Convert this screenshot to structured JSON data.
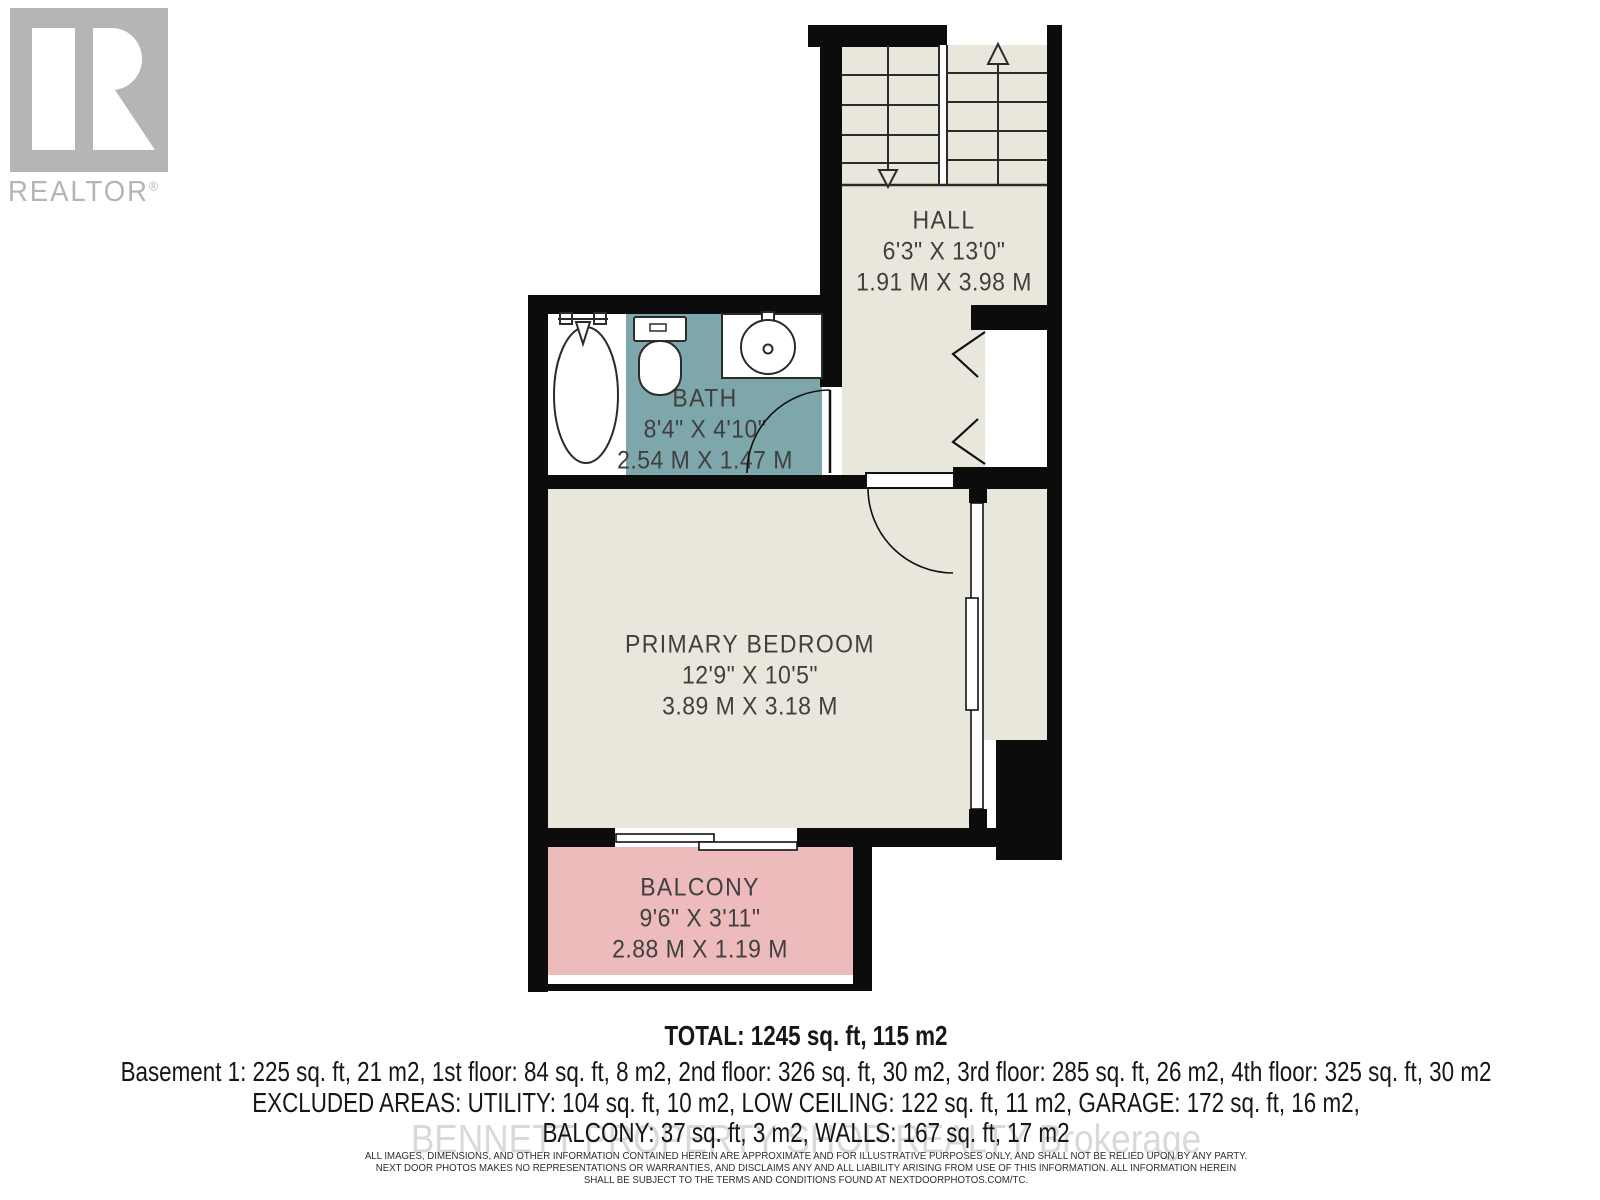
{
  "branding": {
    "logo_text": "REALTOR",
    "registered_mark": "®"
  },
  "floor_plan": {
    "rooms": [
      {
        "name": "HALL",
        "dimensions_imperial": "6'3\" X 13'0\"",
        "dimensions_metric": "1.91 M X 3.98 M"
      },
      {
        "name": "BATH",
        "dimensions_imperial": "8'4\" X 4'10\"",
        "dimensions_metric": "2.54 M X 1.47 M"
      },
      {
        "name": "PRIMARY BEDROOM",
        "dimensions_imperial": "12'9\" X 10'5\"",
        "dimensions_metric": "3.89 M X 3.18 M"
      },
      {
        "name": "BALCONY",
        "dimensions_imperial": "9'6\" X 3'11\"",
        "dimensions_metric": "2.88 M X 1.19 M"
      }
    ],
    "features": [
      "staircase-up",
      "staircase-down",
      "bathtub",
      "toilet",
      "sink",
      "swing-doors",
      "bifold-closet-door",
      "window",
      "sliding-patio-door"
    ]
  },
  "summary": {
    "total": "TOTAL: 1245 sq. ft, 115 m2",
    "floors": "Basement 1: 225 sq. ft, 21 m2, 1st floor: 84 sq. ft, 8 m2, 2nd floor: 326 sq. ft, 30 m2, 3rd floor: 285 sq. ft, 26 m2, 4th floor: 325 sq. ft, 30 m2",
    "excluded_line1": "EXCLUDED AREAS: UTILITY: 104 sq. ft, 10 m2, LOW CEILING: 122 sq. ft, 11 m2, GARAGE: 172 sq. ft, 16 m2,",
    "excluded_line2": "BALCONY: 37 sq. ft, 3 m2, WALLS: 167 sq. ft, 17 m2"
  },
  "watermark": "BENNETT PROPERTY SHOP REALTY Brokerage",
  "disclaimer": {
    "line1": "ALL IMAGES, DIMENSIONS, AND OTHER INFORMATION CONTAINED HEREIN ARE APPROXIMATE AND FOR ILLUSTRATIVE PURPOSES ONLY, AND SHALL NOT BE RELIED UPON BY ANY PARTY.",
    "line2": "NEXT DOOR PHOTOS MAKES NO REPRESENTATIONS OR WARRANTIES, AND DISCLAIMS ANY AND ALL LIABILITY ARISING FROM USE OF THIS INFORMATION. ALL INFORMATION HEREIN",
    "line3": "SHALL BE SUBJECT TO THE TERMS AND CONDITIONS FOUND AT NEXTDOORPHOTOS.COM/TC."
  },
  "colors": {
    "wall": "#0c0c0c",
    "floor": "#e9e7dc",
    "bath_floor": "#7ea7ab",
    "balcony_floor": "#eebbbd",
    "label_text": "#3f3f3f",
    "logo_gray": "#b5b5b5",
    "watermark_gray": "#d9d9d9"
  }
}
